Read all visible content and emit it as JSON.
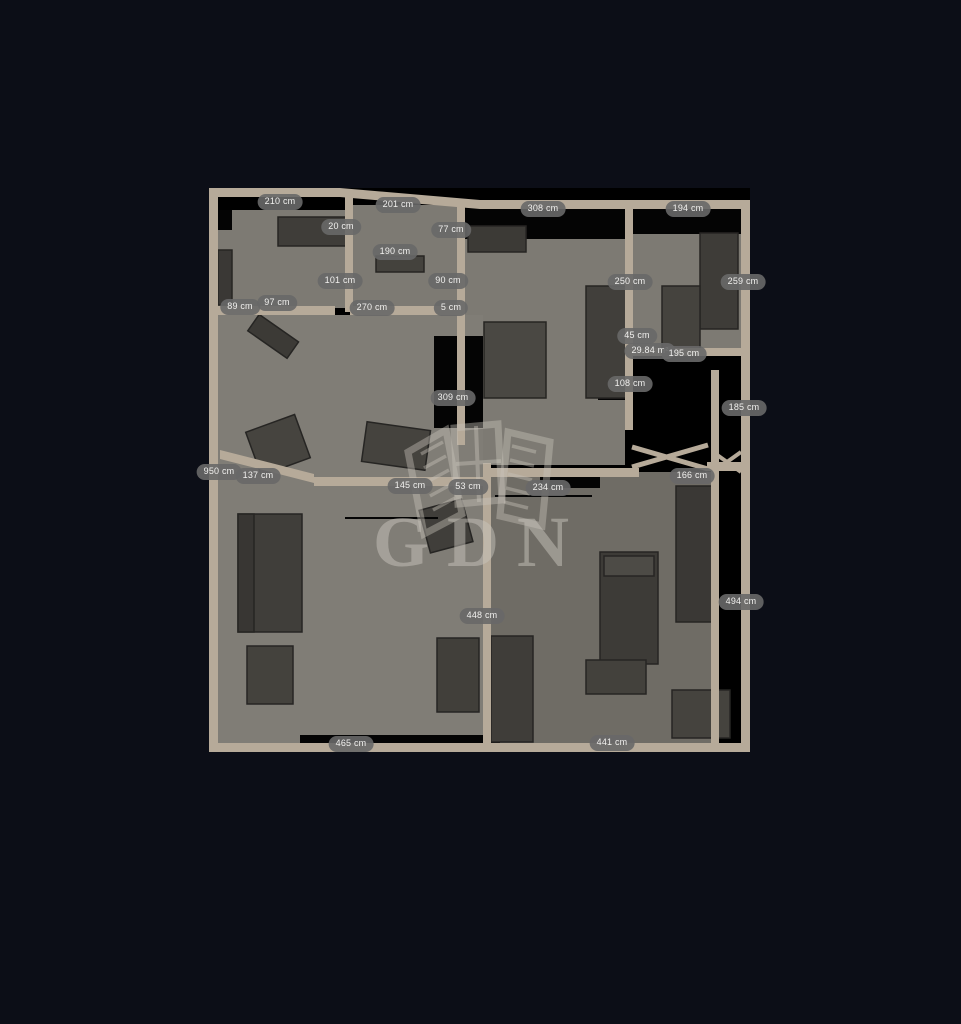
{
  "watermark": {
    "text": "GDN",
    "color": "#c7c3bb"
  },
  "colors": {
    "background": "#0c0e17",
    "wall": "#b6aa99",
    "floor": "#7d7a73",
    "floor_dark": "#6f6c65",
    "furniture": "#43413d",
    "void": "#000000",
    "label_bg": "#686868",
    "label_text": "#f1f0ee"
  },
  "measurements": [
    {
      "text": "210 cm",
      "x": 280,
      "y": 202
    },
    {
      "text": "201 cm",
      "x": 398,
      "y": 205
    },
    {
      "text": "308 cm",
      "x": 543,
      "y": 209
    },
    {
      "text": "194 cm",
      "x": 688,
      "y": 209
    },
    {
      "text": "20 cm",
      "x": 341,
      "y": 227
    },
    {
      "text": "77 cm",
      "x": 451,
      "y": 230
    },
    {
      "text": "190 cm",
      "x": 395,
      "y": 252
    },
    {
      "text": "101 cm",
      "x": 340,
      "y": 281
    },
    {
      "text": "90 cm",
      "x": 448,
      "y": 281
    },
    {
      "text": "250 cm",
      "x": 630,
      "y": 282
    },
    {
      "text": "259 cm",
      "x": 743,
      "y": 282
    },
    {
      "text": "89 cm",
      "x": 240,
      "y": 307
    },
    {
      "text": "97 cm",
      "x": 277,
      "y": 303
    },
    {
      "text": "270 cm",
      "x": 372,
      "y": 308
    },
    {
      "text": "5 cm",
      "x": 451,
      "y": 308
    },
    {
      "text": "45 cm",
      "x": 637,
      "y": 336
    },
    {
      "text": "29.84 m²",
      "x": 650,
      "y": 351
    },
    {
      "text": "195 cm",
      "x": 684,
      "y": 354
    },
    {
      "text": "108 cm",
      "x": 630,
      "y": 384
    },
    {
      "text": "309 cm",
      "x": 453,
      "y": 398
    },
    {
      "text": "185 cm",
      "x": 744,
      "y": 408
    },
    {
      "text": "950 cm",
      "x": 219,
      "y": 472
    },
    {
      "text": "137 cm",
      "x": 258,
      "y": 476
    },
    {
      "text": "166 cm",
      "x": 692,
      "y": 476
    },
    {
      "text": "145 cm",
      "x": 410,
      "y": 486
    },
    {
      "text": "53 cm",
      "x": 468,
      "y": 487
    },
    {
      "text": "234 cm",
      "x": 548,
      "y": 488
    },
    {
      "text": "494 cm",
      "x": 741,
      "y": 602
    },
    {
      "text": "448 cm",
      "x": 482,
      "y": 616
    },
    {
      "text": "465 cm",
      "x": 351,
      "y": 744
    },
    {
      "text": "441 cm",
      "x": 612,
      "y": 743
    }
  ]
}
